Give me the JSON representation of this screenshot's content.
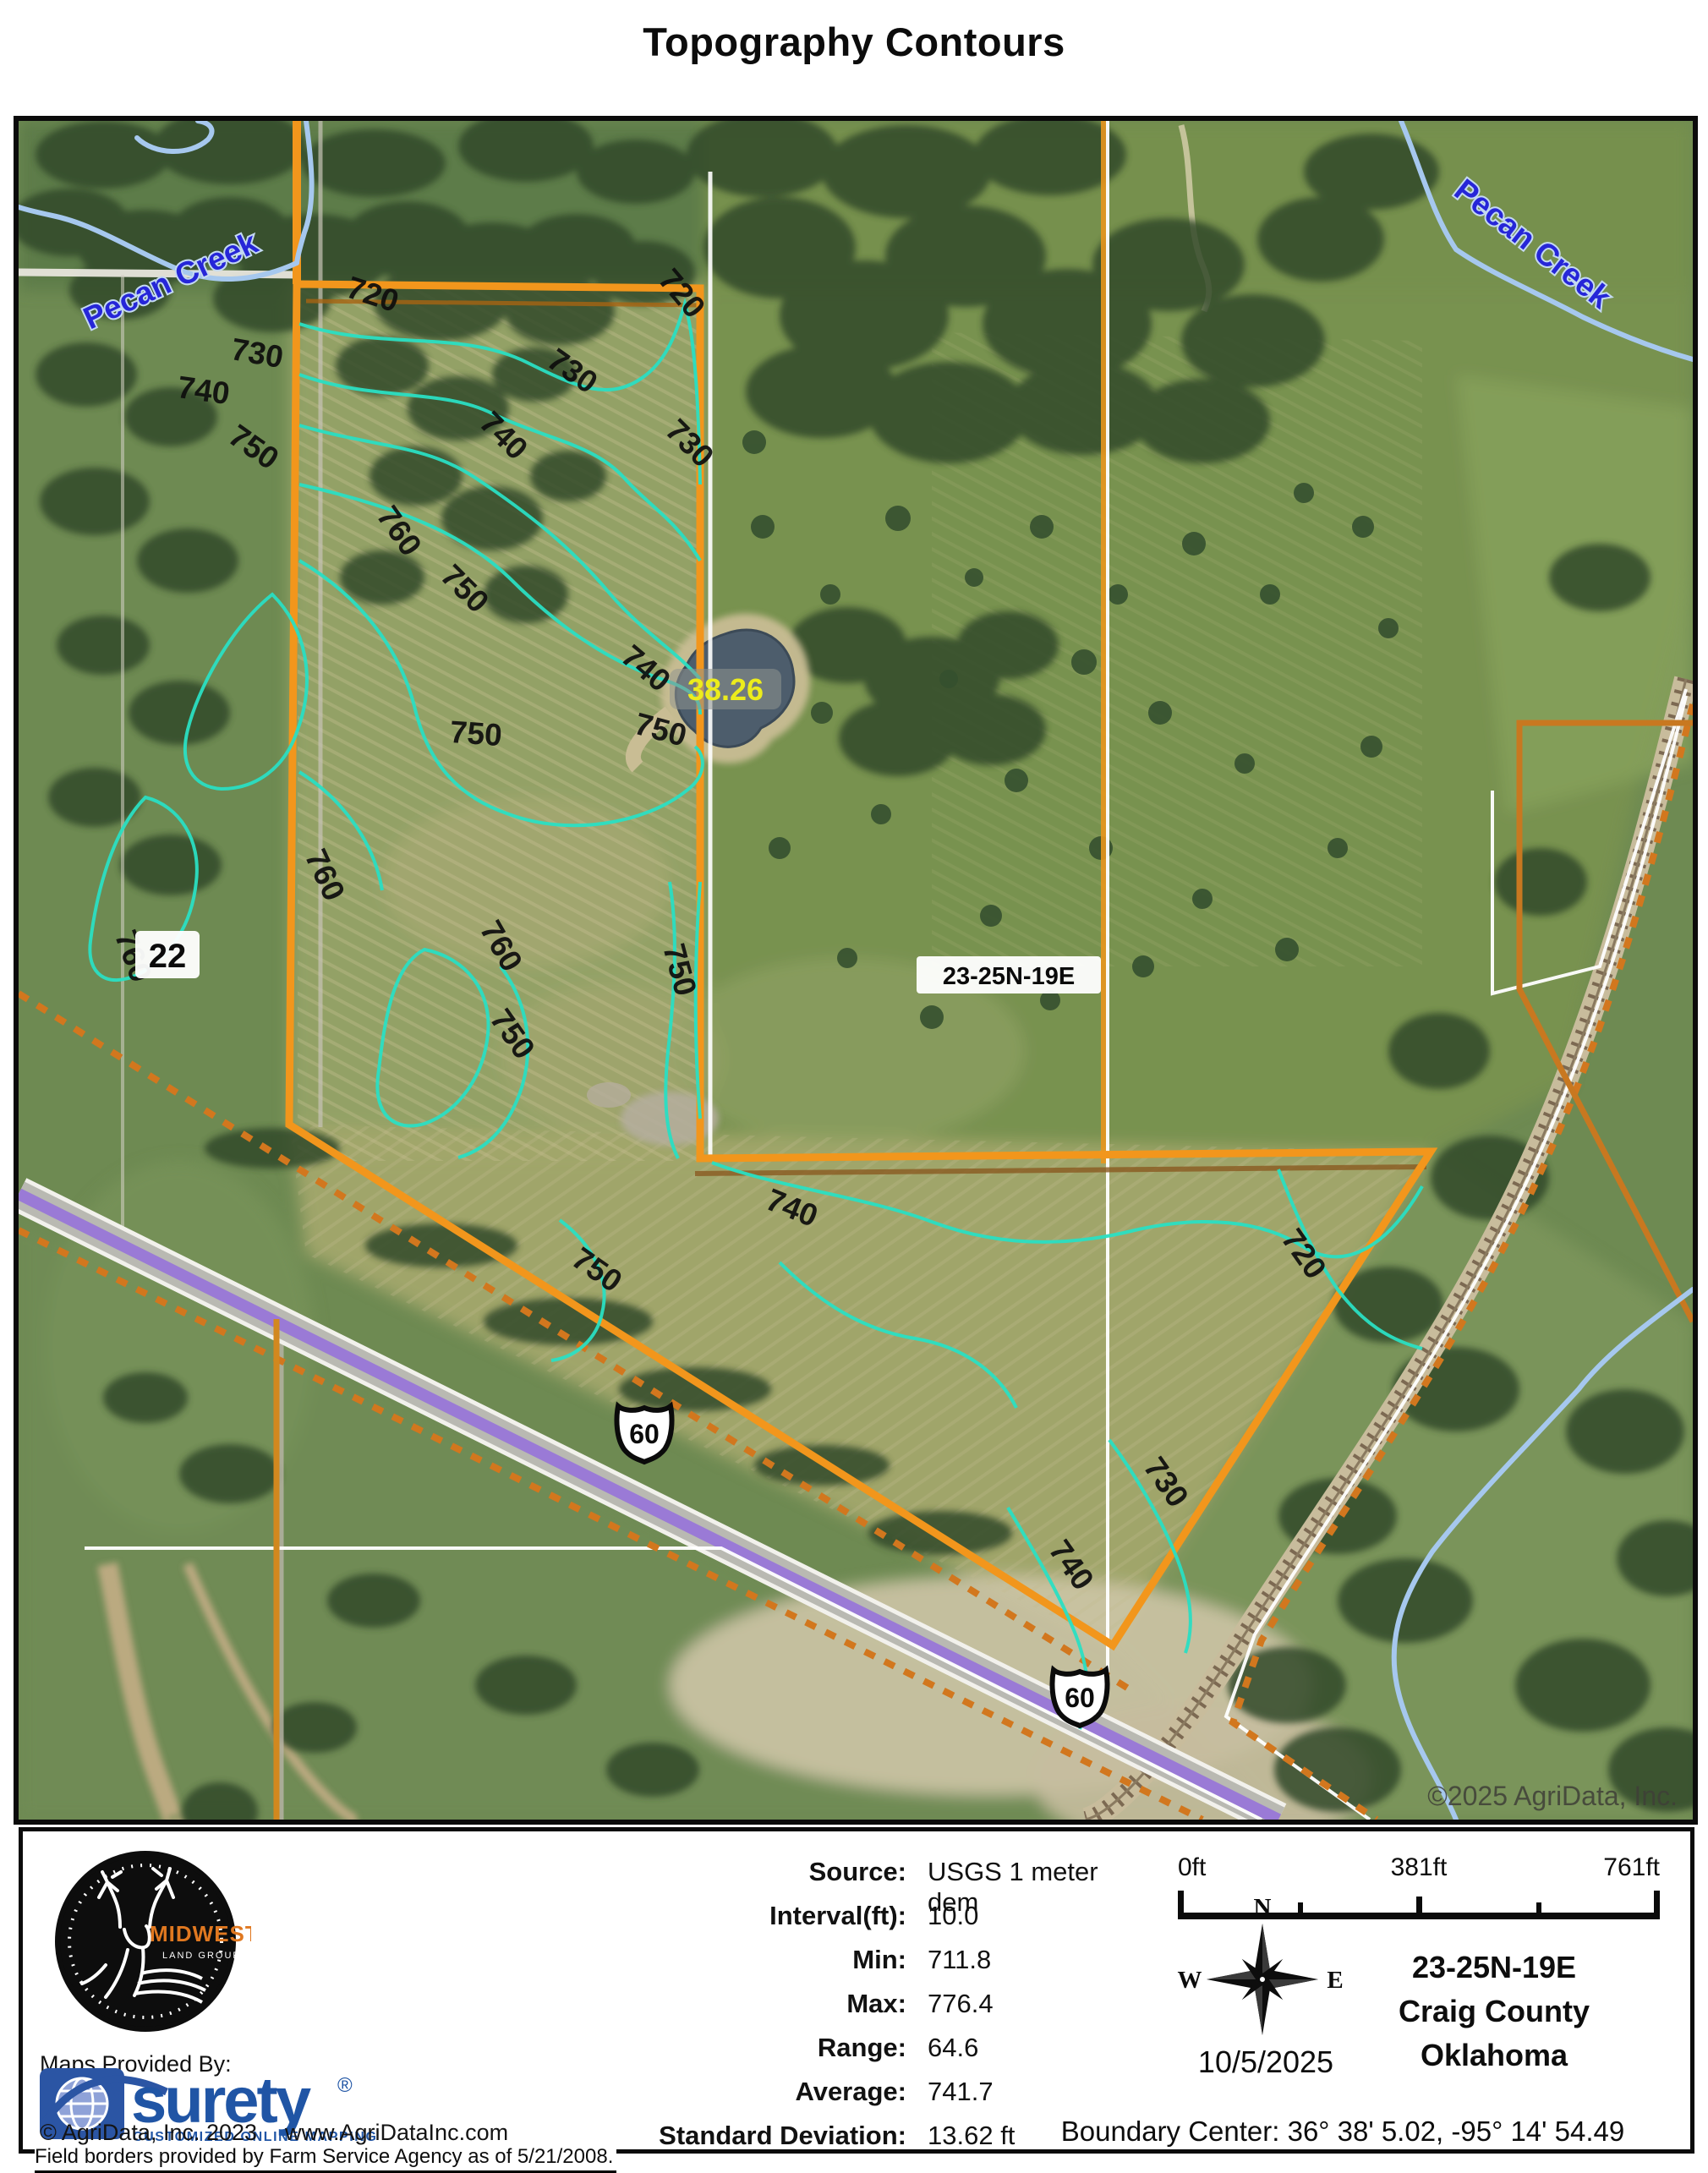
{
  "title": "Topography Contours",
  "map": {
    "creek_label_left": "Pecan Creek",
    "creek_label_right": "Pecan Creek",
    "acreage_label": "38.26",
    "section_number": "22",
    "township_box_label": "23-25N-19E",
    "shield_1": "60",
    "shield_2": "60",
    "copyright_watermark": "©2025 AgriData, Inc.",
    "contour_labels": [
      {
        "text": "720"
      },
      {
        "text": "720"
      },
      {
        "text": "730"
      },
      {
        "text": "730"
      },
      {
        "text": "730"
      },
      {
        "text": "740"
      },
      {
        "text": "740"
      },
      {
        "text": "750"
      },
      {
        "text": "760"
      },
      {
        "text": "750"
      },
      {
        "text": "740"
      },
      {
        "text": "750"
      },
      {
        "text": "750"
      },
      {
        "text": "760"
      },
      {
        "text": "760"
      },
      {
        "text": "760"
      },
      {
        "text": "750"
      },
      {
        "text": "750"
      },
      {
        "text": "740"
      },
      {
        "text": "750"
      },
      {
        "text": "720"
      },
      {
        "text": "730"
      },
      {
        "text": "740"
      }
    ]
  },
  "footer": {
    "logo": {
      "brand": "MIDWEST",
      "sub": "LAND GROUP"
    },
    "maps_provided_by": "Maps Provided By:",
    "surety": {
      "name": "surety",
      "registered": "®",
      "tagline": "CUSTOMIZED ONLINE MAPPING"
    },
    "copyright": "© AgriData, Inc. 2023",
    "website": "www.AgriDataInc.com",
    "field_borders_note": "Field borders provided by Farm Service Agency as of 5/21/2008.",
    "stats": {
      "rows": [
        {
          "label": "Source:",
          "value": "USGS 1 meter dem"
        },
        {
          "label": "Interval(ft):",
          "value": "10.0"
        },
        {
          "label": "Min:",
          "value": "711.8"
        },
        {
          "label": "Max:",
          "value": "776.4"
        },
        {
          "label": "Range:",
          "value": "64.6"
        },
        {
          "label": "Average:",
          "value": "741.7"
        },
        {
          "label": "Standard Deviation:",
          "value": "13.62 ft"
        }
      ]
    },
    "scale": {
      "start": "0ft",
      "mid": "381ft",
      "end": "761ft"
    },
    "compass": {
      "n": "N",
      "e": "E",
      "s": "S",
      "w": "W"
    },
    "date": "10/5/2025",
    "location": {
      "township": "23-25N-19E",
      "county": "Craig County",
      "state": "Oklahoma"
    },
    "boundary_center": "Boundary Center: 36° 38' 5.02,  -95° 14' 54.49"
  }
}
